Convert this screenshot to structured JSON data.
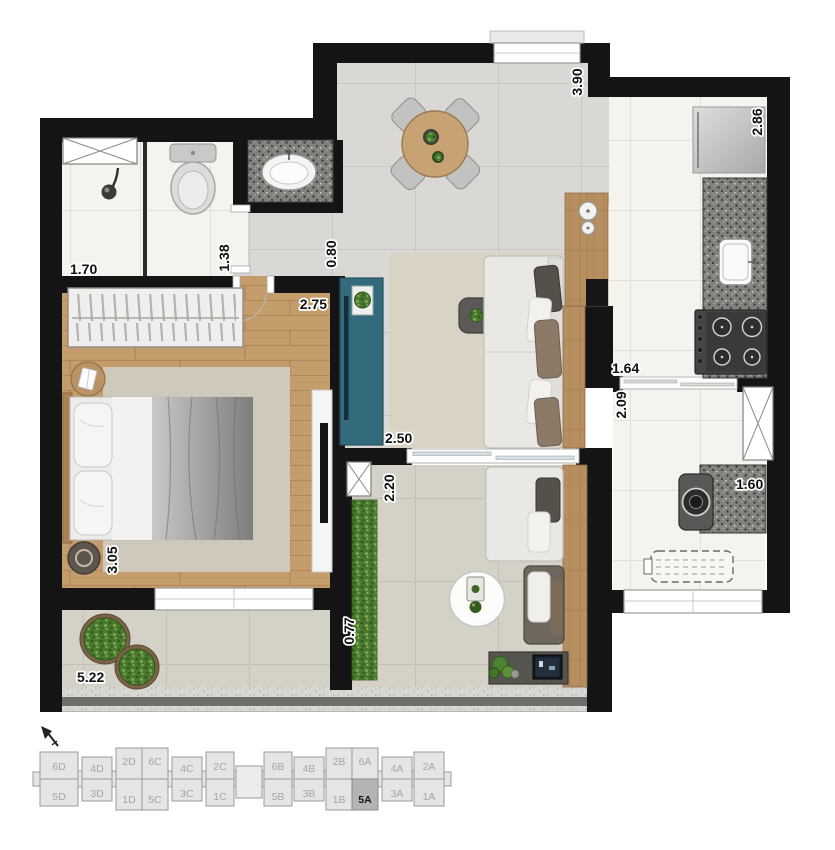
{
  "colors": {
    "wall": "#141414",
    "tile_gray": "#d9d8d4",
    "tile_white": "#f5f3ee",
    "tile_beige": "#d4d1c7",
    "wood": "#c59c6c",
    "granite": "#80807c",
    "tv_cabinet_teal": "#336a7c",
    "keyplan_highlight": "#b4b4b2"
  },
  "dimensions": {
    "shower_width": "1.70",
    "wc_width": "1.38",
    "hall_width": "0.80",
    "bedroom_width": "2.75",
    "dining_depth": "3.90",
    "kitchen_depth": "2.86",
    "kitchen_width": "1.64",
    "service_depth": "2.09",
    "living_width": "2.50",
    "den_depth": "2.20",
    "service_width": "1.60",
    "bedroom_depth": "3.05",
    "terrace_depth": "0.77",
    "terrace_width": "5.22"
  },
  "keyplan": {
    "top_row": [
      "6D",
      "4D",
      "2D",
      "6C",
      "4C",
      "2C",
      "6B",
      "4B",
      "2B",
      "6A",
      "4A",
      "2A"
    ],
    "bottom_row": [
      "5D",
      "3D",
      "1D",
      "5C",
      "3C",
      "1C",
      "5B",
      "3B",
      "1B",
      "5A",
      "3A",
      "1A"
    ],
    "highlighted_unit": "5A"
  }
}
